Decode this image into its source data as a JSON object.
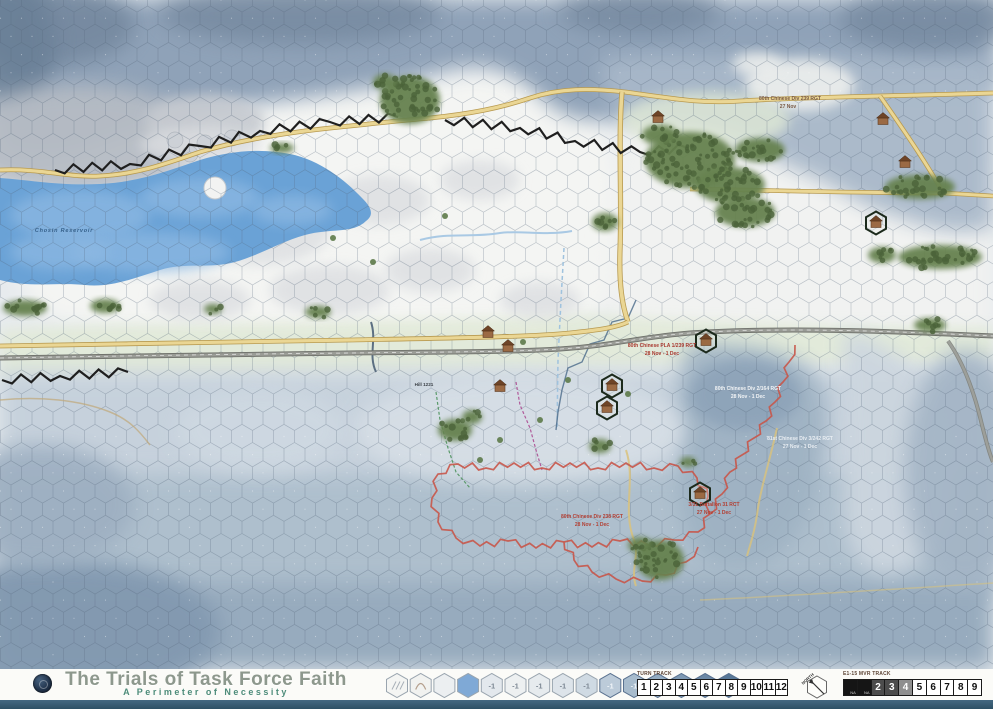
{
  "footer": {
    "title": "The Trials of Task Force Faith",
    "subtitle": "A Perimeter of Necessity",
    "turn_track": {
      "label": "TURN TRACK",
      "cells": [
        "1",
        "2",
        "3",
        "4",
        "5",
        "6",
        "7",
        "8",
        "9",
        "10",
        "11",
        "12"
      ]
    },
    "mvr_track": {
      "label": "E1-15 MVR TRACK",
      "cells": [
        {
          "text": "",
          "na": "NA",
          "style": "black"
        },
        {
          "text": "",
          "na": "NA",
          "style": "black"
        },
        {
          "text": "2",
          "style": "dark"
        },
        {
          "text": "3",
          "style": "dark"
        },
        {
          "text": "4",
          "style": "mid"
        },
        {
          "text": "5",
          "style": "light"
        },
        {
          "text": "6",
          "style": "light"
        },
        {
          "text": "7",
          "style": "light"
        },
        {
          "text": "8",
          "style": "light"
        },
        {
          "text": "9",
          "style": "light"
        }
      ]
    },
    "north_label": "NORTH",
    "terrain_key": [
      {
        "color": "#f4f5f3",
        "label": ""
      },
      {
        "color": "#f1f2f0",
        "label": ""
      },
      {
        "color": "#eceff1",
        "label": ""
      },
      {
        "color": "#7fa9d6",
        "label": ""
      },
      {
        "color": "#e3e8ed",
        "label": "-1"
      },
      {
        "color": "#edf0f1",
        "label": "-1"
      },
      {
        "color": "#e6ebee",
        "label": "-1"
      },
      {
        "color": "#dde4ea",
        "label": "-1"
      },
      {
        "color": "#cfdae3",
        "label": "-1"
      },
      {
        "color": "#bccbd9",
        "label": "-1"
      },
      {
        "color": "#a8bccd",
        "label": "-1"
      },
      {
        "color": "#93abc1",
        "label": "-1"
      },
      {
        "color": "#7e99b3",
        "label": "-1"
      },
      {
        "color": "#6b88a5",
        "label": "-1"
      },
      {
        "color": "#587898",
        "label": "-1"
      }
    ]
  },
  "map": {
    "accent_colors": {
      "road_yellow": "#ead694",
      "road_gray": "#7e807a",
      "ridge_black": "#1f1f1f",
      "perimeter_red": "#c8564a",
      "water_blue": "#6aa2d6",
      "forest_green": "#66824f"
    },
    "labels": [
      {
        "text": "Chosin Reservoir",
        "x": 64,
        "y": 232,
        "color": "#35608a",
        "size": 5.5,
        "italic": true,
        "ls": 0.8
      },
      {
        "text": "80th Chinese Div 239 RGT",
        "x": 790,
        "y": 100,
        "color": "#7a5a46",
        "size": 5
      },
      {
        "text": "27 Nov",
        "x": 788,
        "y": 108,
        "color": "#7a5a46",
        "size": 5
      },
      {
        "text": "80th Chinese PLA 1/239 RGT",
        "x": 662,
        "y": 347,
        "color": "#a8382e",
        "size": 5
      },
      {
        "text": "28 Nov - 1 Dec",
        "x": 662,
        "y": 355,
        "color": "#a8382e",
        "size": 5
      },
      {
        "text": "80th Chinese Div 2/164 RGT",
        "x": 748,
        "y": 390,
        "color": "#f2f4f6",
        "size": 5
      },
      {
        "text": "28 Nov - 1 Dec",
        "x": 748,
        "y": 398,
        "color": "#f2f4f6",
        "size": 5
      },
      {
        "text": "81st Chinese Div 3/242 RGT",
        "x": 800,
        "y": 440,
        "color": "#e9eef3",
        "size": 5
      },
      {
        "text": "27 Nov - 1 Dec",
        "x": 800,
        "y": 448,
        "color": "#e9eef3",
        "size": 5
      },
      {
        "text": "80th Chinese Div 238 RGT",
        "x": 592,
        "y": 518,
        "color": "#b23f33",
        "size": 5
      },
      {
        "text": "28 Nov - 1 Dec",
        "x": 592,
        "y": 526,
        "color": "#b23f33",
        "size": 5
      },
      {
        "text": "3/31 Battalion 31 RCT",
        "x": 714,
        "y": 506,
        "color": "#b23f33",
        "size": 5
      },
      {
        "text": "27 Nov - 1 Dec",
        "x": 714,
        "y": 514,
        "color": "#b23f33",
        "size": 5
      },
      {
        "text": "Hill 1221",
        "x": 424,
        "y": 386,
        "color": "#3a3f45",
        "size": 4.6
      }
    ]
  }
}
